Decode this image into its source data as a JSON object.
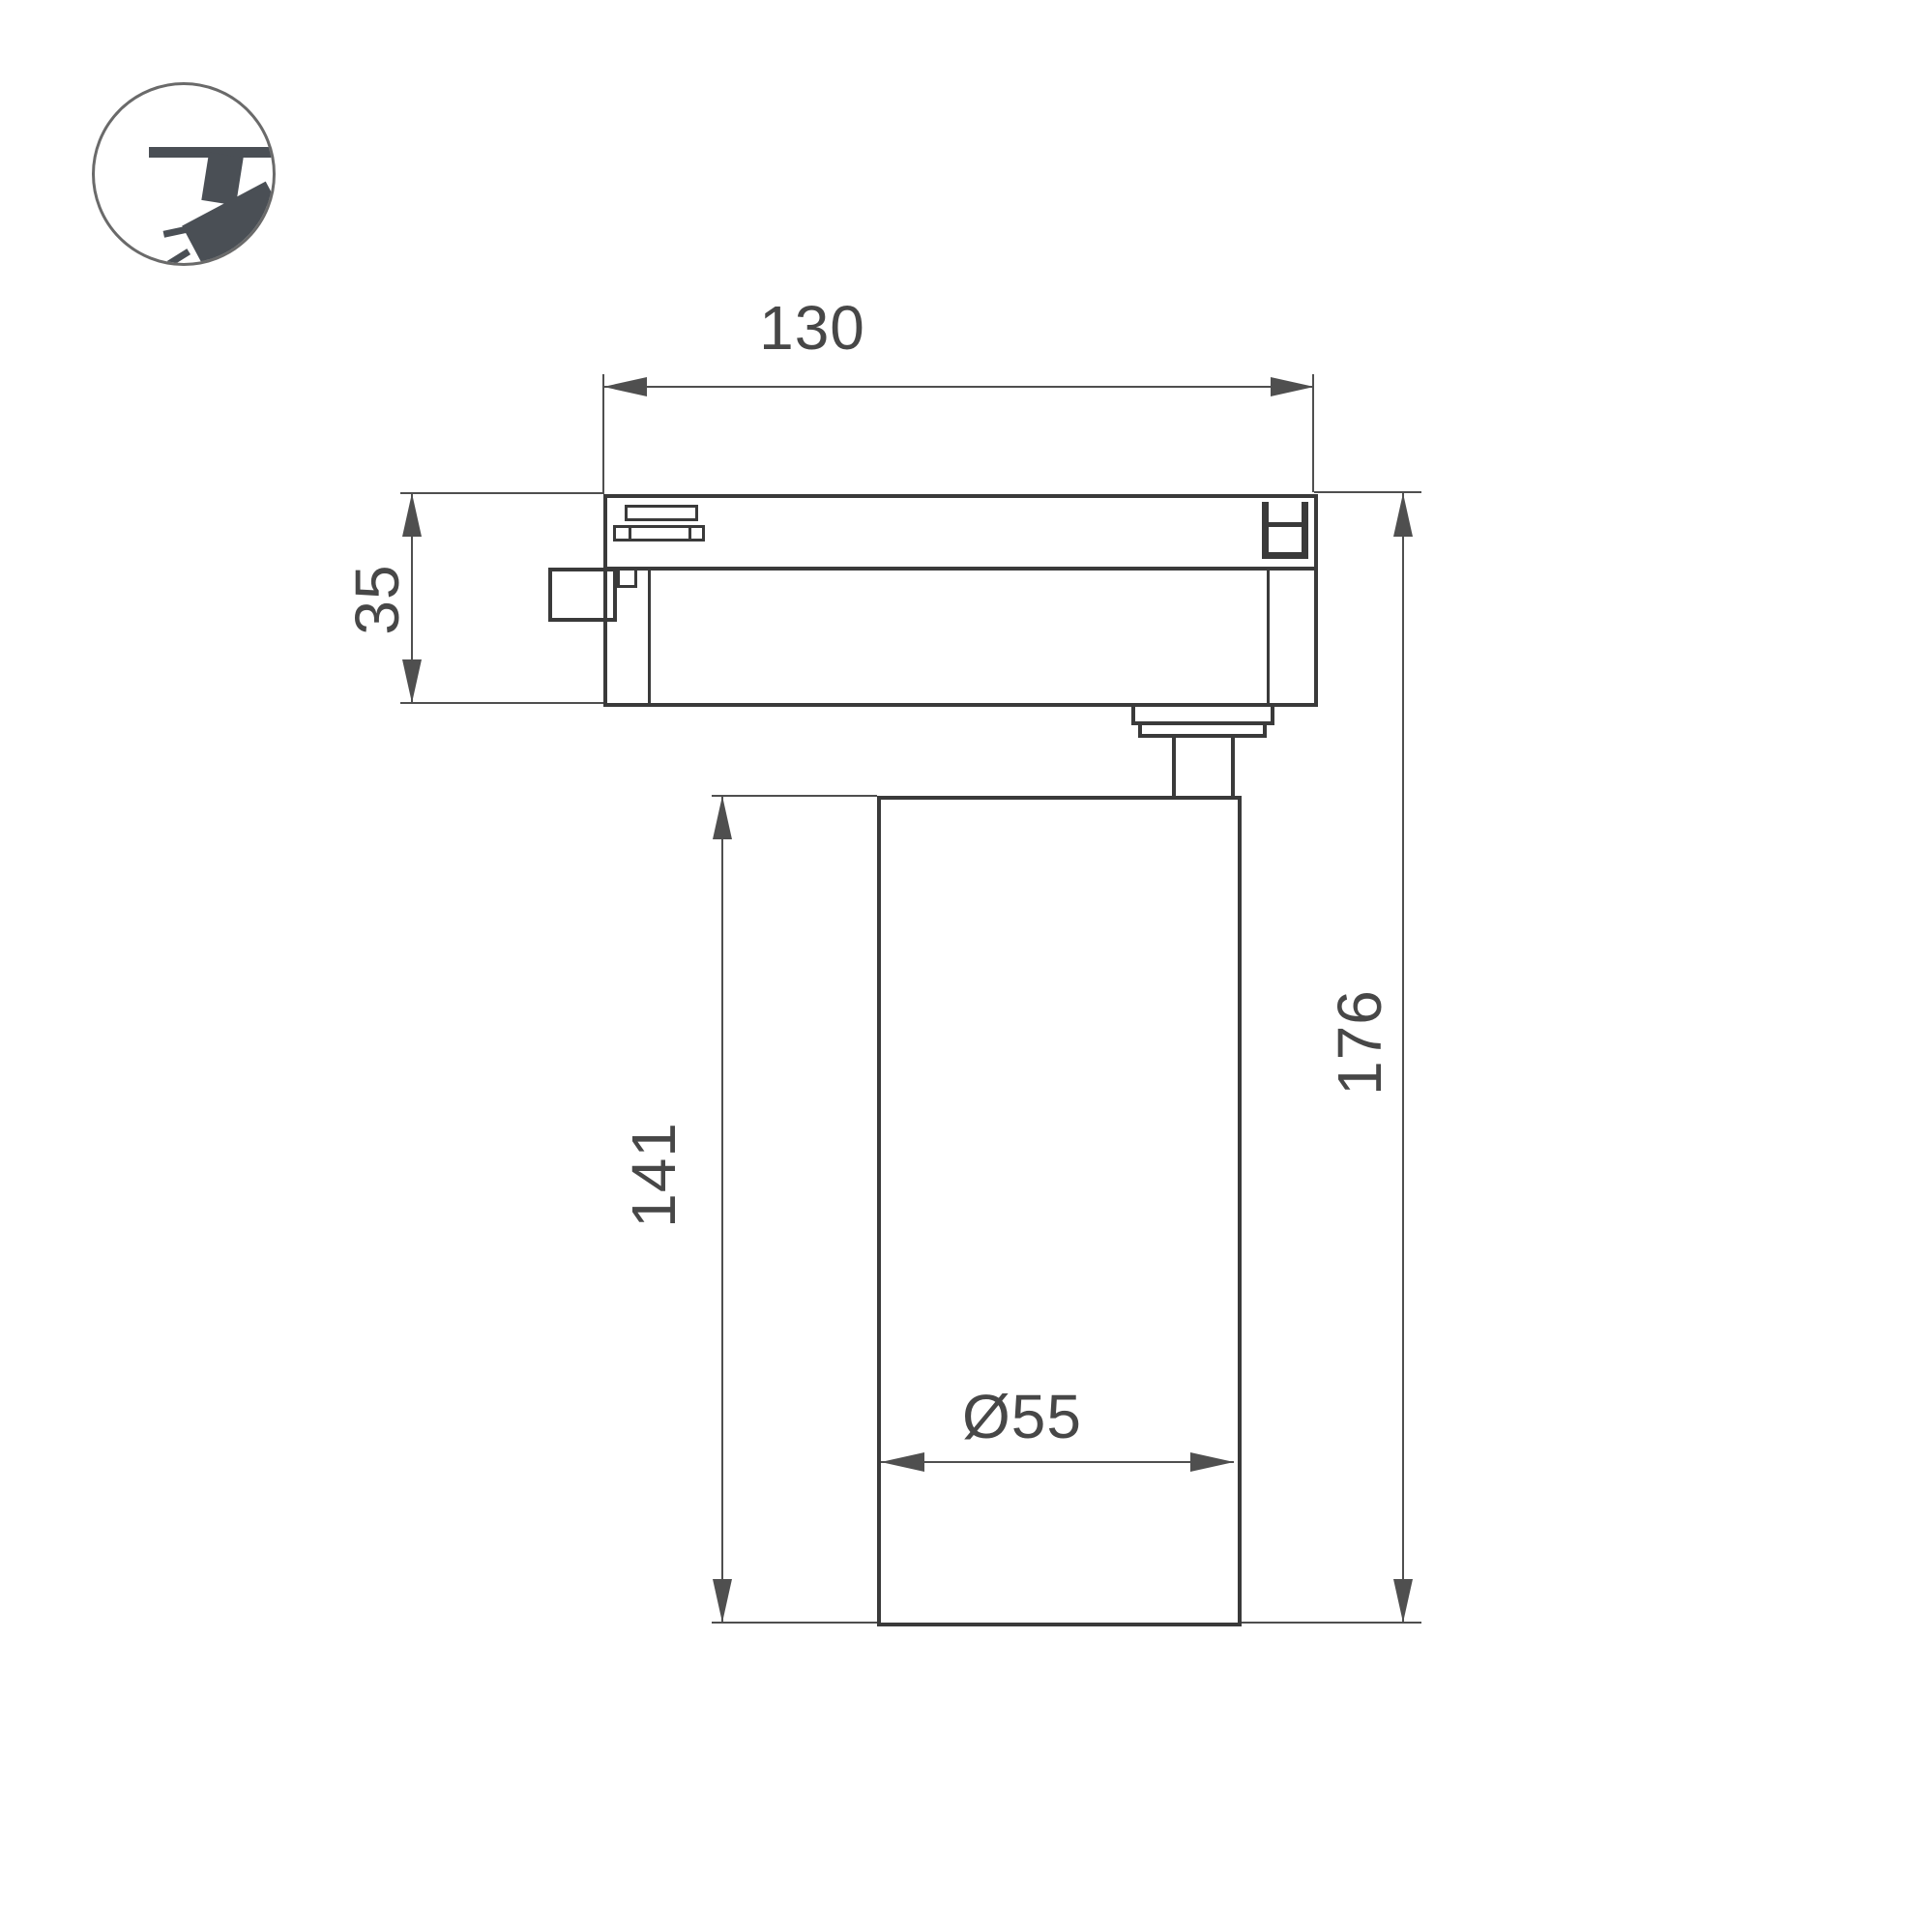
{
  "icon": {
    "name": "track-spotlight-icon"
  },
  "dimensions": {
    "adapter_width": {
      "value": "130"
    },
    "adapter_height": {
      "value": "35"
    },
    "body_height": {
      "value": "141"
    },
    "total_height": {
      "value": "176"
    },
    "body_diameter": {
      "value": "Ø55"
    }
  },
  "colors": {
    "outline": "#3a3a3a",
    "dimension_lines": "#4f4f4f",
    "label_text": "#474747",
    "icon_fill": "#4a4f55",
    "background": "#ffffff"
  }
}
